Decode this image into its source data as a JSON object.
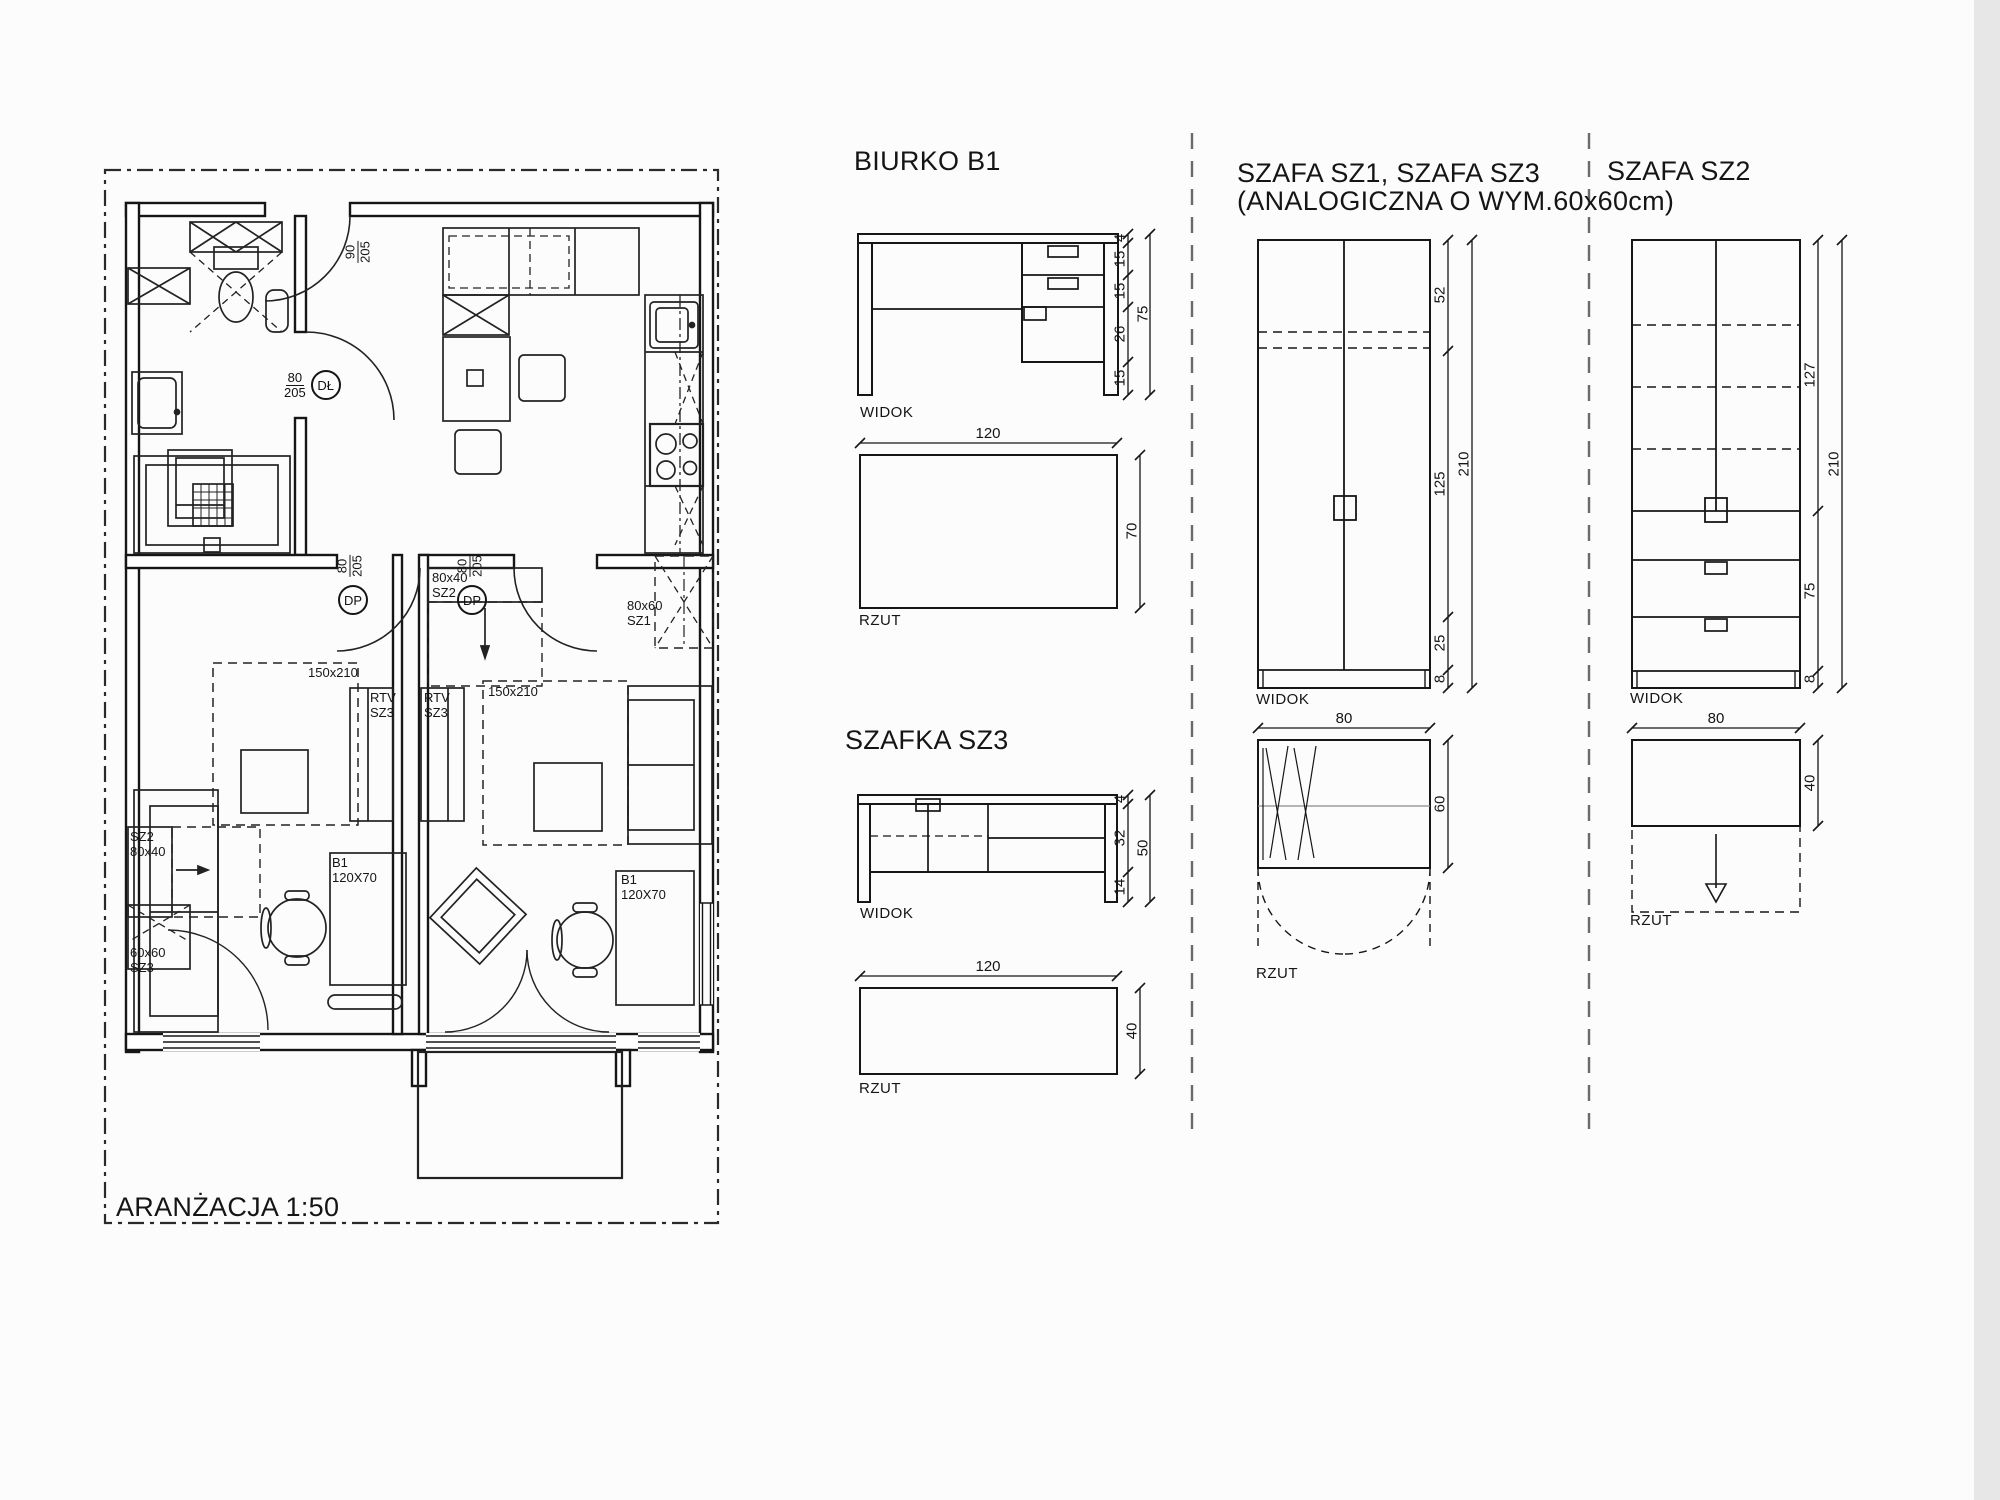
{
  "plan": {
    "title": "ARANŻACJA 1:50",
    "doors": {
      "entry": {
        "width": "90",
        "height": "205"
      },
      "bathroom": {
        "width": "80",
        "height": "205",
        "code": "DŁ"
      },
      "room_left": {
        "width": "80",
        "height": "205",
        "code": "DP"
      },
      "room_right": {
        "width": "80",
        "height": "205",
        "code": "DP"
      }
    },
    "furniture_labels": {
      "rtv_left": [
        "RTV",
        "SZ3"
      ],
      "rtv_right": [
        "RTV",
        "SZ3"
      ],
      "bed_left": "150x210",
      "bed_right": "150x210",
      "shelf_sz2_right": [
        "80x40",
        "SZ2"
      ],
      "wardrobe_sz1": [
        "80x60",
        "SZ1"
      ],
      "wardrobe_sz2_left": [
        "SZ2",
        "80x40"
      ],
      "cabinet_sz3_left": [
        "60x60",
        "SZ3"
      ],
      "desk_left": [
        "B1",
        "120X70"
      ],
      "desk_right": [
        "B1",
        "120X70"
      ]
    }
  },
  "details": {
    "biurko": {
      "title": "BIURKO B1",
      "view_label": "WIDOK",
      "plan_label": "RZUT",
      "width": "120",
      "depth": "70",
      "height_total": "75",
      "heights": [
        "4",
        "15",
        "15",
        "26",
        "15"
      ]
    },
    "szafka": {
      "title": "SZAFKA SZ3",
      "view_label": "WIDOK",
      "plan_label": "RZUT",
      "width": "120",
      "depth": "40",
      "height_total": "50",
      "heights": [
        "4",
        "32",
        "14"
      ]
    },
    "szafa1": {
      "title_line1": "SZAFA SZ1, SZAFA SZ3",
      "title_line2": "(ANALOGICZNA O WYM.60x60cm)",
      "view_label": "WIDOK",
      "plan_label": "RZUT",
      "width": "80",
      "depth": "60",
      "height_total": "210",
      "heights": [
        "52",
        "125",
        "25",
        "8"
      ]
    },
    "szafa2": {
      "title": "SZAFA SZ2",
      "view_label": "WIDOK",
      "plan_label": "RZUT",
      "width": "80",
      "depth": "40",
      "height_total": "210",
      "heights": [
        "127",
        "75",
        "8"
      ]
    }
  }
}
